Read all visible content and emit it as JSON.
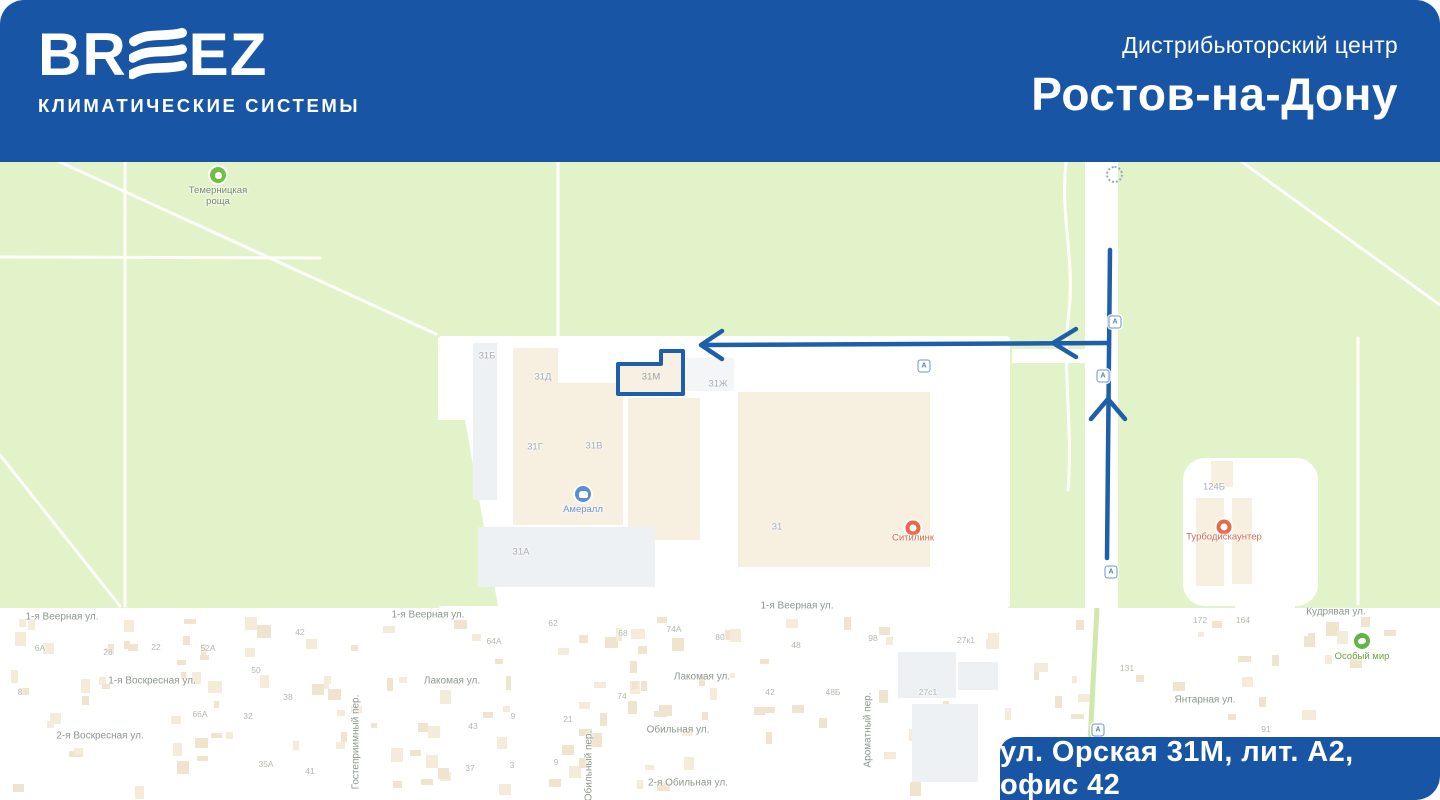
{
  "header": {
    "logo": {
      "part1": "BR",
      "part2": "EZ",
      "subtitle": "КЛИМАТИЧЕСКИЕ СИСТЕМЫ"
    },
    "center_label": "Дистрибьюторский центр",
    "city": "Ростов-на-Дону",
    "bg_color": "#1856a5"
  },
  "address_badge": {
    "text": "ул. Орская 31М, лит. А2, офис 42",
    "bg_color": "#1856a5"
  },
  "colors": {
    "route_blue": "#1e5faa",
    "map_green": "#e2f3ca",
    "building_beige": "#f7efe0",
    "building_gray": "#eef1f4",
    "marker_orange": "#e8684a",
    "marker_green": "#6fbf44",
    "marker_blue": "#5b8ed6"
  },
  "map": {
    "destination": {
      "label": "31М"
    },
    "building_labels": [
      {
        "text": "31Б",
        "x": 487,
        "y": 356
      },
      {
        "text": "31Д",
        "x": 543,
        "y": 377
      },
      {
        "text": "31Г",
        "x": 535,
        "y": 447
      },
      {
        "text": "31В",
        "x": 594,
        "y": 446
      },
      {
        "text": "31Ж",
        "x": 718,
        "y": 384
      },
      {
        "text": "31А",
        "x": 521,
        "y": 552
      },
      {
        "text": "31",
        "x": 777,
        "y": 527
      },
      {
        "text": "124Б",
        "x": 1214,
        "y": 487
      }
    ],
    "street_labels": [
      {
        "text": "1-я Веерная ул.",
        "x": 62,
        "y": 617
      },
      {
        "text": "1-я Веерная ул.",
        "x": 428,
        "y": 615
      },
      {
        "text": "1-я Веерная ул.",
        "x": 797,
        "y": 606
      },
      {
        "text": "1-я Воскресная ул.",
        "x": 152,
        "y": 681
      },
      {
        "text": "2-я Воскресная ул.",
        "x": 100,
        "y": 736
      },
      {
        "text": "Лакомая ул.",
        "x": 452,
        "y": 681
      },
      {
        "text": "Лакомая ул.",
        "x": 702,
        "y": 677
      },
      {
        "text": "Обильная ул.",
        "x": 678,
        "y": 730
      },
      {
        "text": "2-я Обильная ул.",
        "x": 688,
        "y": 783
      },
      {
        "text": "Кудрявая ул.",
        "x": 1336,
        "y": 612
      },
      {
        "text": "Янтарная ул.",
        "x": 1205,
        "y": 700
      },
      {
        "text": "Гостеприимный пер.",
        "x": 356,
        "y": 742,
        "rotate": -90
      },
      {
        "text": "Ароматный пер.",
        "x": 868,
        "y": 730,
        "rotate": -90
      },
      {
        "text": "Обильный пер.",
        "x": 589,
        "y": 766,
        "rotate": -90
      }
    ],
    "house_numbers": [
      {
        "text": "6А",
        "x": 40,
        "y": 648
      },
      {
        "text": "28",
        "x": 108,
        "y": 652
      },
      {
        "text": "22",
        "x": 156,
        "y": 647
      },
      {
        "text": "52А",
        "x": 208,
        "y": 648
      },
      {
        "text": "42",
        "x": 300,
        "y": 632
      },
      {
        "text": "8",
        "x": 20,
        "y": 692
      },
      {
        "text": "50",
        "x": 256,
        "y": 670
      },
      {
        "text": "38",
        "x": 288,
        "y": 697
      },
      {
        "text": "66А",
        "x": 200,
        "y": 714
      },
      {
        "text": "32",
        "x": 248,
        "y": 716
      },
      {
        "text": "35А",
        "x": 266,
        "y": 764
      },
      {
        "text": "41",
        "x": 310,
        "y": 771
      },
      {
        "text": "64А",
        "x": 494,
        "y": 641
      },
      {
        "text": "62",
        "x": 553,
        "y": 623
      },
      {
        "text": "68",
        "x": 623,
        "y": 633
      },
      {
        "text": "74А",
        "x": 674,
        "y": 629
      },
      {
        "text": "80",
        "x": 720,
        "y": 637
      },
      {
        "text": "74",
        "x": 622,
        "y": 696
      },
      {
        "text": "9",
        "x": 513,
        "y": 716
      },
      {
        "text": "21",
        "x": 568,
        "y": 719
      },
      {
        "text": "43",
        "x": 473,
        "y": 726
      },
      {
        "text": "37",
        "x": 470,
        "y": 768
      },
      {
        "text": "3",
        "x": 512,
        "y": 765
      },
      {
        "text": "9",
        "x": 556,
        "y": 762
      },
      {
        "text": "48",
        "x": 796,
        "y": 645
      },
      {
        "text": "98",
        "x": 873,
        "y": 638
      },
      {
        "text": "27к1",
        "x": 966,
        "y": 640
      },
      {
        "text": "42",
        "x": 770,
        "y": 692
      },
      {
        "text": "48Б",
        "x": 833,
        "y": 692
      },
      {
        "text": "27с1",
        "x": 928,
        "y": 692
      },
      {
        "text": "172",
        "x": 1200,
        "y": 620
      },
      {
        "text": "164",
        "x": 1243,
        "y": 620
      },
      {
        "text": "131",
        "x": 1127,
        "y": 668
      },
      {
        "text": "91",
        "x": 1266,
        "y": 729
      }
    ],
    "markers": [
      {
        "name": "park",
        "icon": "tree",
        "x": 218,
        "y": 175,
        "color": "#6fbf44",
        "label_lines": [
          "Темерницкая",
          "роща"
        ],
        "label_color": "#778a6a"
      },
      {
        "name": "averall",
        "icon": "store",
        "x": 583,
        "y": 494,
        "color": "#5b8ed6",
        "label_lines": [
          "Амералл"
        ],
        "label_color": "#6c92cf"
      },
      {
        "name": "citilink",
        "icon": "ring",
        "x": 913,
        "y": 528,
        "color": "#e8684a",
        "label_lines": [
          "Ситилинк"
        ],
        "label_color": "#cb6f57"
      },
      {
        "name": "turbodiscounter",
        "icon": "ring",
        "x": 1224,
        "y": 527,
        "color": "#e8684a",
        "label_lines": [
          "Турбодискаунтер"
        ],
        "label_color": "#cb6f57"
      },
      {
        "name": "osobiy-mir",
        "icon": "paw",
        "x": 1362,
        "y": 641,
        "color": "#62b545",
        "label_lines": [
          "Особый мир"
        ],
        "label_color": "#69a53f"
      }
    ],
    "bus_stops": [
      {
        "x": 924,
        "y": 366
      },
      {
        "x": 1115,
        "y": 322
      },
      {
        "x": 1103,
        "y": 376
      },
      {
        "x": 1111,
        "y": 572
      },
      {
        "x": 1098,
        "y": 730
      }
    ],
    "bus_glyph": "А"
  }
}
